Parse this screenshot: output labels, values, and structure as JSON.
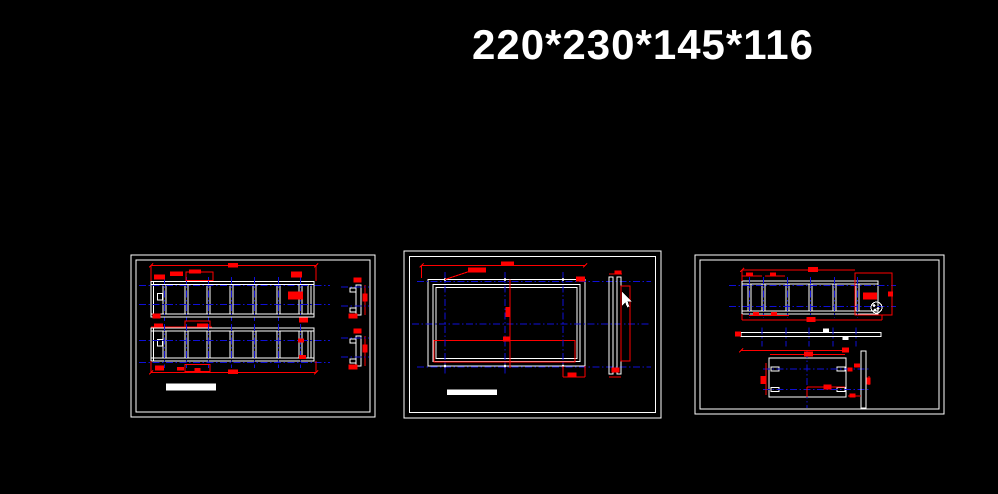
{
  "title": {
    "text": "220*230*145*116"
  },
  "canvas": {
    "width": 998,
    "height": 494,
    "background": "#000000"
  },
  "colors": {
    "w": "#ffffff",
    "r": "#ff0000",
    "b": "#0f0fd8",
    "dash": "7 2.5 1.5 2.5"
  },
  "cursor": {
    "points": "622,292 622,305.5 625.4,302.6 627.3,307.4 629.4,306.4 627.5,301.6 631.6,301.6",
    "color": "#ffffff"
  },
  "panels": [
    {
      "name": "panel-left",
      "frame": {
        "x": 131,
        "y": 255,
        "w": 244,
        "h": 162,
        "inset": 5
      },
      "shapes": [
        [
          "LAD",
          151,
          281.5,
          163,
          35.5,
          3,
          [
            163,
            185,
            207,
            230,
            253,
            277,
            299,
            308
          ]
        ],
        [
          "L",
          153.5,
          281.5,
          153.5,
          317,
          "w"
        ],
        [
          "R",
          157.5,
          293.5,
          5,
          6.5,
          "w"
        ],
        [
          "L",
          139,
          285.5,
          330,
          285.5,
          "b",
          1
        ],
        [
          "L",
          139,
          304.5,
          330,
          304.5,
          "b",
          1
        ],
        [
          "VT",
          [
            164.5,
            186.5,
            208.5,
            231.5,
            254.5,
            278.5,
            300.5
          ],
          277,
          321
        ],
        [
          "L",
          151,
          265.5,
          316,
          265.5,
          "r"
        ],
        [
          "L",
          151,
          265.5,
          151,
          281,
          "r"
        ],
        [
          "L",
          316,
          265.5,
          316,
          281,
          "r"
        ],
        [
          "L",
          149,
          267.5,
          153,
          263.5,
          "r"
        ],
        [
          "L",
          314,
          267.5,
          318,
          263.5,
          "r"
        ],
        [
          "F",
          228,
          263,
          10,
          4.5,
          "r"
        ],
        [
          "F",
          154,
          274.5,
          11,
          5,
          "r"
        ],
        [
          "F",
          170,
          271.5,
          13,
          4.5,
          "r"
        ],
        [
          "R",
          186,
          272,
          27,
          8.5,
          "r"
        ],
        [
          "F",
          189,
          269.5,
          12,
          4,
          "r"
        ],
        [
          "F",
          291,
          271.5,
          11,
          6,
          "r"
        ],
        [
          "F",
          288,
          291.5,
          15,
          8,
          "r"
        ],
        [
          "F",
          299,
          317.5,
          9,
          5,
          "r"
        ],
        [
          "F",
          152.5,
          313.5,
          8,
          5,
          "r"
        ],
        [
          "L",
          151,
          327,
          212,
          327,
          "r"
        ],
        [
          "F",
          154,
          323.5,
          9,
          4.5,
          "r"
        ],
        [
          "F",
          197,
          323.5,
          11,
          4.5,
          "r"
        ],
        [
          "R",
          185,
          321,
          25,
          6,
          "r"
        ],
        [
          "LAD",
          151,
          328,
          163,
          33,
          3,
          [
            163,
            185,
            207,
            230,
            253,
            277,
            299,
            308
          ]
        ],
        [
          "L",
          153.5,
          328,
          153.5,
          361,
          "w"
        ],
        [
          "R",
          157.5,
          339.5,
          5,
          6.5,
          "w"
        ],
        [
          "L",
          139,
          340.5,
          330,
          340.5,
          "b",
          1
        ],
        [
          "L",
          139,
          362.3,
          330,
          362.3,
          "b",
          1
        ],
        [
          "VT",
          [
            164.5,
            186.5,
            208.5,
            231.5,
            254.5,
            278.5,
            300.5
          ],
          324,
          368
        ],
        [
          "F",
          298,
          338.5,
          6,
          4,
          "r"
        ],
        [
          "F",
          299,
          355,
          7,
          4,
          "r"
        ],
        [
          "F",
          155,
          365.5,
          9,
          5,
          "r"
        ],
        [
          "F",
          177,
          367,
          7,
          3.5,
          "r"
        ],
        [
          "F",
          194.5,
          368,
          6,
          3,
          "r"
        ],
        [
          "R",
          185,
          364.5,
          25,
          7,
          "r"
        ],
        [
          "L",
          151,
          372.5,
          316,
          372.5,
          "r"
        ],
        [
          "L",
          151,
          361,
          151,
          372.5,
          "r"
        ],
        [
          "L",
          316,
          361,
          316,
          372.5,
          "r"
        ],
        [
          "L",
          149,
          374.5,
          153,
          370.5,
          "r"
        ],
        [
          "L",
          314,
          374.5,
          318,
          370.5,
          "r"
        ],
        [
          "F",
          228,
          369.5,
          10,
          4.5,
          "r"
        ],
        [
          "R",
          356,
          285,
          5,
          30,
          "w"
        ],
        [
          "R",
          350,
          288,
          6,
          4,
          "w"
        ],
        [
          "R",
          350,
          308,
          6,
          4,
          "w"
        ],
        [
          "F",
          353.5,
          277.5,
          8,
          5,
          "r"
        ],
        [
          "L",
          365,
          285,
          365,
          315,
          "r"
        ],
        [
          "F",
          362.5,
          293.5,
          5,
          8,
          "r"
        ],
        [
          "F",
          348.5,
          313.5,
          9,
          5,
          "r"
        ],
        [
          "L",
          341,
          287,
          369,
          287,
          "b",
          1
        ],
        [
          "L",
          341,
          306,
          369,
          306,
          "b",
          1
        ],
        [
          "R",
          356,
          336,
          5,
          30,
          "w"
        ],
        [
          "R",
          350,
          339,
          6,
          4,
          "w"
        ],
        [
          "R",
          350,
          359,
          6,
          4,
          "w"
        ],
        [
          "F",
          353.5,
          328.5,
          8,
          5,
          "r"
        ],
        [
          "L",
          365,
          336,
          365,
          366,
          "r"
        ],
        [
          "F",
          362.5,
          344.5,
          5,
          8,
          "r"
        ],
        [
          "F",
          348.5,
          364.5,
          9,
          5,
          "r"
        ],
        [
          "L",
          341,
          338,
          369,
          338,
          "b",
          1
        ],
        [
          "L",
          341,
          357,
          369,
          357,
          "b",
          1
        ],
        [
          "F",
          166,
          383.5,
          50,
          7,
          "w"
        ]
      ]
    },
    {
      "name": "panel-center",
      "frame": {
        "x": 404,
        "y": 251,
        "w": 257,
        "h": 167,
        "inset": 5.5
      },
      "shapes": [
        [
          "R",
          428,
          279.5,
          157,
          86.5,
          "w"
        ],
        [
          "R",
          433,
          284.5,
          147,
          77,
          "w"
        ],
        [
          "R",
          436,
          287.5,
          141,
          71,
          "w"
        ],
        [
          "R",
          434,
          340.5,
          141,
          21.5,
          "r"
        ],
        [
          "L",
          445,
          272,
          445,
          374,
          "b",
          1
        ],
        [
          "L",
          505,
          272,
          505,
          374,
          "b",
          1
        ],
        [
          "L",
          563,
          272,
          563,
          374,
          "b",
          1
        ],
        [
          "L",
          417,
          281.3,
          651,
          281.3,
          "b",
          1
        ],
        [
          "L",
          412,
          324,
          651,
          324,
          "b",
          1
        ],
        [
          "L",
          417,
          367,
          651,
          367,
          "b",
          1
        ],
        [
          "D",
          445,
          279.5
        ],
        [
          "D",
          505,
          279.5
        ],
        [
          "D",
          563,
          279.5
        ],
        [
          "D",
          445,
          366
        ],
        [
          "D",
          505,
          366
        ],
        [
          "D",
          563,
          366
        ],
        [
          "L",
          421.7,
          265.3,
          585,
          265.3,
          "r"
        ],
        [
          "L",
          421.7,
          265.3,
          421.7,
          278,
          "r"
        ],
        [
          "L",
          419.7,
          267.3,
          423.7,
          263.3,
          "r"
        ],
        [
          "L",
          583,
          267.3,
          587,
          263.3,
          "r"
        ],
        [
          "F",
          468,
          267.5,
          18,
          5,
          "r"
        ],
        [
          "F",
          501,
          261.5,
          13,
          4,
          "r"
        ],
        [
          "L",
          445,
          279.5,
          469,
          271.5,
          "r"
        ],
        [
          "F",
          576,
          276.5,
          9,
          5,
          "r"
        ],
        [
          "L",
          510,
          279.5,
          510,
          368,
          "r"
        ],
        [
          "F",
          505.5,
          307,
          5,
          10,
          "r"
        ],
        [
          "F",
          503,
          336.5,
          7,
          5,
          "r"
        ],
        [
          "L",
          563,
          377,
          585,
          377,
          "r"
        ],
        [
          "L",
          563,
          366,
          563,
          377,
          "r"
        ],
        [
          "L",
          585,
          366,
          585,
          377,
          "r"
        ],
        [
          "F",
          567.5,
          372.5,
          9,
          5,
          "r"
        ],
        [
          "R",
          609,
          277,
          4,
          97,
          "w"
        ],
        [
          "R",
          617,
          277,
          4,
          97,
          "w"
        ],
        [
          "R",
          621,
          286,
          9,
          75,
          "r"
        ],
        [
          "F",
          614.5,
          270.5,
          7,
          4,
          "r"
        ],
        [
          "L",
          609,
          274,
          622,
          274,
          "r"
        ],
        [
          "F",
          611.5,
          367.5,
          8,
          5,
          "r"
        ],
        [
          "L",
          609,
          377,
          621,
          377,
          "r"
        ],
        [
          "F",
          447,
          389.5,
          50,
          5.5,
          "w"
        ]
      ]
    },
    {
      "name": "panel-right",
      "frame": {
        "x": 695,
        "y": 255,
        "w": 249,
        "h": 159,
        "inset": 5
      },
      "shapes": [
        [
          "LAD",
          742,
          281,
          136,
          33,
          3,
          [
            748,
            762,
            786,
            809,
            833,
            856
          ]
        ],
        [
          "L",
          729,
          285.5,
          896,
          285.5,
          "b",
          1
        ],
        [
          "L",
          729,
          306.5,
          896,
          306.5,
          "b",
          1
        ],
        [
          "VT",
          [
            749.5,
            763.5,
            787.5,
            810.5,
            834.5,
            857.5
          ],
          277,
          318
        ],
        [
          "R",
          855,
          273,
          37,
          42,
          "r"
        ],
        [
          "F",
          863,
          292.5,
          14,
          7,
          "r"
        ],
        [
          "C",
          876.5,
          307.5,
          5.5,
          "w"
        ],
        [
          "D",
          874,
          305.5
        ],
        [
          "D",
          878,
          308.5
        ],
        [
          "D",
          875,
          310
        ],
        [
          "F",
          888,
          291.5,
          5,
          5,
          "r"
        ],
        [
          "L",
          742,
          270,
          855,
          270,
          "r"
        ],
        [
          "L",
          742,
          270,
          742,
          281,
          "r"
        ],
        [
          "L",
          740,
          272,
          744,
          268,
          "r"
        ],
        [
          "F",
          808,
          267,
          10,
          5,
          "r"
        ],
        [
          "L",
          742,
          276,
          762,
          276,
          "r"
        ],
        [
          "F",
          746,
          272.5,
          7,
          4,
          "r"
        ],
        [
          "L",
          765,
          276,
          785,
          276,
          "r"
        ],
        [
          "F",
          770,
          272.5,
          6,
          4,
          "r"
        ],
        [
          "L",
          742,
          320,
          882,
          320,
          "r"
        ],
        [
          "L",
          742,
          314,
          742,
          320,
          "r"
        ],
        [
          "L",
          882,
          315,
          882,
          320,
          "r"
        ],
        [
          "F",
          806.5,
          317,
          9,
          5,
          "r"
        ],
        [
          "L",
          749,
          315.5,
          789,
          315.5,
          "r"
        ],
        [
          "F",
          753,
          312,
          6,
          4,
          "r"
        ],
        [
          "F",
          771,
          312,
          6,
          4,
          "r"
        ],
        [
          "R",
          741,
          332.5,
          140,
          4,
          "w"
        ],
        [
          "F",
          735,
          331.5,
          6,
          5,
          "r"
        ],
        [
          "VT",
          [
            762,
            786,
            809,
            833,
            856
          ],
          327.5,
          346.5
        ],
        [
          "F",
          823,
          328.5,
          6,
          3.5,
          "w"
        ],
        [
          "F",
          842.5,
          336.5,
          6,
          3.5,
          "w"
        ],
        [
          "L",
          741,
          350.5,
          848,
          350.5,
          "r"
        ],
        [
          "F",
          842,
          347.5,
          7,
          5,
          "r"
        ],
        [
          "L",
          739,
          352.5,
          743,
          348.5,
          "r"
        ],
        [
          "R",
          769,
          358,
          77,
          39,
          "w"
        ],
        [
          "R",
          771,
          367,
          8,
          4,
          "w"
        ],
        [
          "R",
          837,
          367,
          8,
          4,
          "w"
        ],
        [
          "R",
          771,
          387.3,
          8,
          4,
          "w"
        ],
        [
          "R",
          837,
          387.3,
          8,
          4,
          "w"
        ],
        [
          "L",
          763,
          369,
          869,
          369,
          "b",
          1
        ],
        [
          "L",
          763,
          389.3,
          869,
          389.3,
          "b",
          1
        ],
        [
          "L",
          807,
          351,
          807,
          408,
          "b",
          1
        ],
        [
          "L",
          770,
          354.5,
          845,
          354.5,
          "r"
        ],
        [
          "F",
          804,
          351.5,
          9,
          5,
          "r"
        ],
        [
          "L",
          766,
          363,
          766,
          395,
          "r"
        ],
        [
          "F",
          760.5,
          376,
          5,
          8,
          "r"
        ],
        [
          "L",
          807,
          387,
          845,
          387,
          "r"
        ],
        [
          "L",
          807,
          387,
          807,
          397,
          "r"
        ],
        [
          "F",
          823.5,
          384.5,
          8,
          5,
          "r"
        ],
        [
          "F",
          847.5,
          367.5,
          5,
          4,
          "r"
        ],
        [
          "R",
          861,
          351,
          5,
          57,
          "w"
        ],
        [
          "F",
          854,
          363.5,
          6,
          4,
          "r"
        ],
        [
          "L",
          869,
          376,
          869,
          385,
          "r"
        ],
        [
          "F",
          866.5,
          377.5,
          4,
          7,
          "r"
        ],
        [
          "L",
          848,
          396,
          861,
          396,
          "r"
        ],
        [
          "F",
          849.5,
          393.5,
          6,
          4,
          "r"
        ]
      ]
    }
  ]
}
